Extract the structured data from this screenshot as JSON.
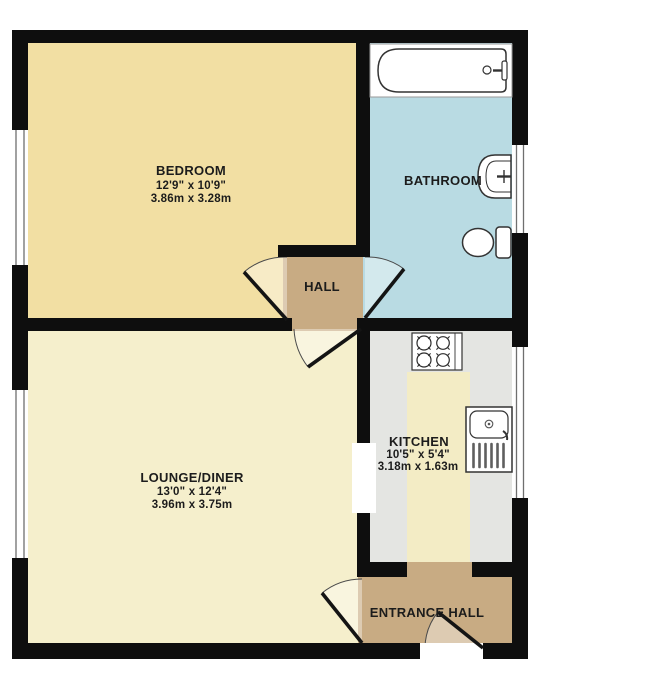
{
  "plan": {
    "colors": {
      "wall": "#0e0e0e",
      "bedroom_floor": "#f2dfa3",
      "bathroom_floor": "#b9dbe3",
      "lounge_floor": "#f5efcc",
      "kitchen_floor": "#e4e5e2",
      "kitchen_walkway": "#f3ecc5",
      "hall_floor": "#c8ab83",
      "entrance_hall_floor": "#c8ab83"
    },
    "rooms": {
      "bedroom": {
        "name": "BEDROOM",
        "dims_imperial": "12'9\" x 10'9\"",
        "dims_metric": "3.86m x 3.28m"
      },
      "bathroom": {
        "name": "BATHROOM"
      },
      "hall": {
        "name": "HALL"
      },
      "lounge": {
        "name": "LOUNGE/DINER",
        "dims_imperial": "13'0\" x 12'4\"",
        "dims_metric": "3.96m x 3.75m"
      },
      "kitchen": {
        "name": "KITCHEN",
        "dims_imperial": "10'5\" x 5'4\"",
        "dims_metric": "3.18m x 1.63m"
      },
      "entrance_hall": {
        "name": "ENTRANCE HALL"
      }
    }
  }
}
